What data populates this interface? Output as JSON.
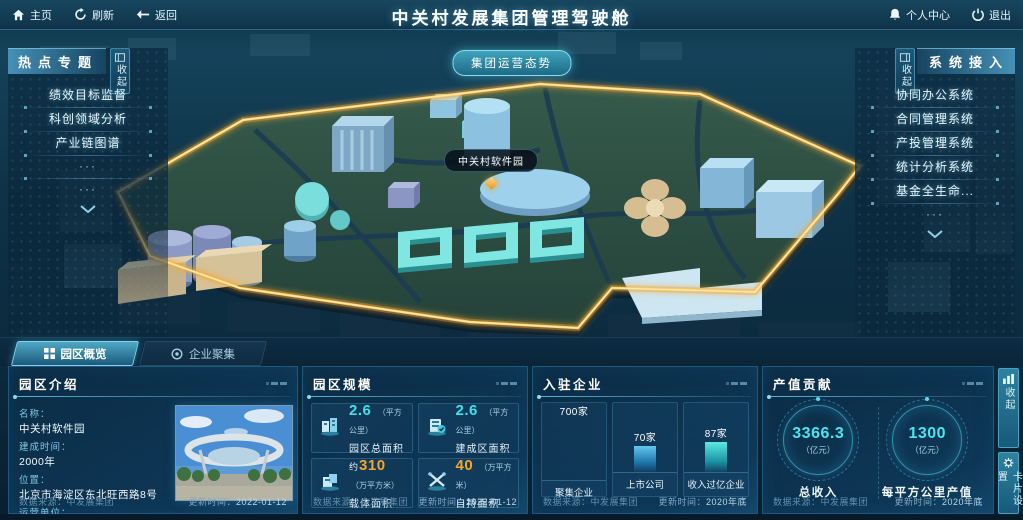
{
  "topbar": {
    "home": "主页",
    "refresh": "刷新",
    "back": "返回",
    "title": "中关村发展集团管理驾驶舱",
    "personal_center": "个人中心",
    "logout": "退出"
  },
  "map": {
    "situation_button": "集团运营态势",
    "marker_label": "中关村软件园"
  },
  "left_panel": {
    "title": "热点专题",
    "collapse": "收起",
    "items": [
      "绩效目标监督",
      "科创领域分析",
      "产业链图谱"
    ],
    "ellipsis": "···"
  },
  "right_panel": {
    "title": "系统接入",
    "collapse": "收起",
    "items": [
      "协同办公系统",
      "合同管理系统",
      "产投管理系统",
      "统计分析系统",
      "基金全生命..."
    ],
    "ellipsis": "···"
  },
  "tabs": [
    {
      "label": "园区概览"
    },
    {
      "label": "企业聚集"
    }
  ],
  "side_buttons": {
    "collapse": "收起",
    "card_settings": "卡片设置"
  },
  "panels": {
    "intro": {
      "title": "园区介绍",
      "fields": [
        {
          "label": "名称：",
          "value": "中关村软件园"
        },
        {
          "label": "建成时间：",
          "value": "2000年"
        },
        {
          "label": "位置：",
          "value": "北京市海淀区东北旺西路8号"
        },
        {
          "label": "运营单位：",
          "value": "北京中关村软件园发展有限公司"
        }
      ],
      "source_label": "数据来源：",
      "source": "中发展集团",
      "updated_label": "更新时间：",
      "updated": "2022-01-12"
    },
    "scale": {
      "title": "园区规模",
      "stats": [
        {
          "prefix": "",
          "value": "2.6",
          "unit": "（平方公里）",
          "label": "园区总面积",
          "color": "#3fe2ea"
        },
        {
          "prefix": "",
          "value": "2.6",
          "unit": "（平方公里）",
          "label": "建成区面积",
          "color": "#3fe2ea"
        },
        {
          "prefix": "约",
          "value": "310",
          "unit": "（万平方米）",
          "label": "载体面积",
          "color": "#f5a62a"
        },
        {
          "prefix": "",
          "value": "40",
          "unit": "（万平方米）",
          "label": "自持面积",
          "color": "#f5a62a"
        }
      ],
      "source_label": "数据来源：",
      "source": "中发展集团",
      "updated_label": "更新时间：",
      "updated": "2022-01-12"
    },
    "enterprises": {
      "title": "入驻企业",
      "bars": [
        {
          "value": "700家",
          "label": "聚集企业",
          "height": "60px",
          "color": "gold"
        },
        {
          "value": "70家",
          "label": "上市公司",
          "height": "26px",
          "color": "blue"
        },
        {
          "value": "87家",
          "label": "收入过亿企业",
          "height": "30px",
          "color": "cyan"
        }
      ],
      "source_label": "数据来源：",
      "source": "中发展集团",
      "updated_label": "更新时间：",
      "updated": "2020年底"
    },
    "output": {
      "title": "产值贡献",
      "gauges": [
        {
          "value": "3366.3",
          "unit": "（亿元）",
          "label": "总收入"
        },
        {
          "value": "1300",
          "unit": "（亿元）",
          "label": "每平方公里产值"
        }
      ],
      "source_label": "数据来源：",
      "source": "中发展集团",
      "updated_label": "更新时间：",
      "updated": "2020年底"
    }
  },
  "chart_data": [
    {
      "type": "bar",
      "title": "入驻企业",
      "categories": [
        "聚集企业",
        "上市公司",
        "收入过亿企业"
      ],
      "values": [
        700,
        70,
        87
      ],
      "unit": "家",
      "xlabel": "",
      "ylabel": "",
      "legend_position": "none",
      "bar_colors": [
        "#e8a93c",
        "#3aa0d8",
        "#3ad8d0"
      ]
    },
    {
      "type": "kpi",
      "title": "产值贡献",
      "items": [
        {
          "label": "总收入",
          "value": 3366.3,
          "unit": "亿元"
        },
        {
          "label": "每平方公里产值",
          "value": 1300,
          "unit": "亿元"
        }
      ]
    },
    {
      "type": "kpi",
      "title": "园区规模",
      "items": [
        {
          "label": "园区总面积",
          "value": 2.6,
          "unit": "平方公里"
        },
        {
          "label": "建成区面积",
          "value": 2.6,
          "unit": "平方公里"
        },
        {
          "label": "载体面积",
          "value": 310,
          "unit": "万平方米",
          "approx": true
        },
        {
          "label": "自持面积",
          "value": 40,
          "unit": "万平方米"
        }
      ]
    }
  ]
}
